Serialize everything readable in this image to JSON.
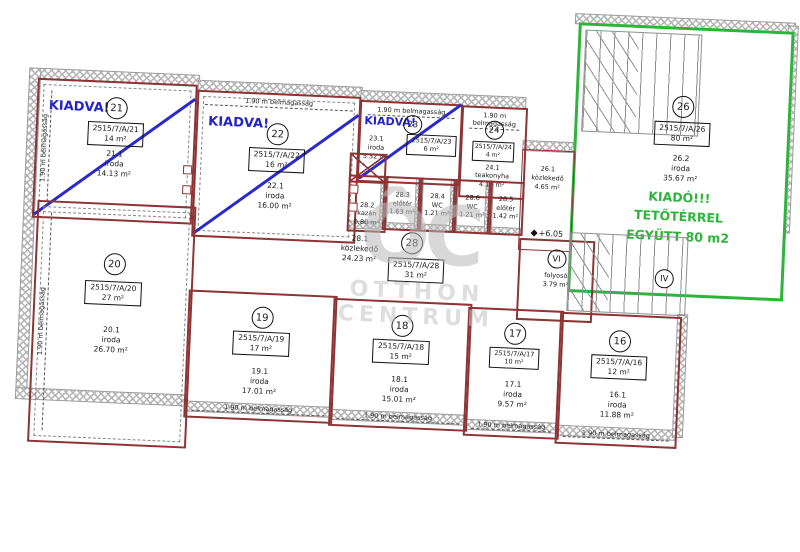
{
  "plan": {
    "height_note": "1.90 m belmagasság",
    "level_mark": "+6.05",
    "watermark": {
      "logo": "ÔC",
      "line1": "OTTHON",
      "line2": "CENTRUM"
    },
    "colors": {
      "wall": "#8d3434",
      "rented_blue": "#2323cc",
      "available_green": "#2eb43c",
      "hatch_gray": "#b4b4b4",
      "watermark_gray": "#c4c4c4"
    },
    "units": {
      "u16": {
        "num": "16",
        "lot": "2515/7/A/16",
        "lot_area": "12 m²",
        "room_no": "16.1",
        "room_type": "iroda",
        "room_area": "11.88 m²"
      },
      "u17": {
        "num": "17",
        "lot": "2515/7/A/17",
        "lot_area": "10 m²",
        "room_no": "17.1",
        "room_type": "iroda",
        "room_area": "9.57 m²"
      },
      "u18": {
        "num": "18",
        "lot": "2515/7/A/18",
        "lot_area": "15 m²",
        "room_no": "18.1",
        "room_type": "iroda",
        "room_area": "15.01 m²"
      },
      "u19": {
        "num": "19",
        "lot": "2515/7/A/19",
        "lot_area": "17 m²",
        "room_no": "19.1",
        "room_type": "iroda",
        "room_area": "17.01 m²"
      },
      "u20": {
        "num": "20",
        "lot": "2515/7/A/20",
        "lot_area": "27 m²",
        "room_no": "20.1",
        "room_type": "iroda",
        "room_area": "26.70 m²"
      },
      "u21": {
        "status": "KIADVA!",
        "num": "21",
        "lot": "2515/7/A/21",
        "lot_area": "14 m²",
        "room_no": "21.1",
        "room_type": "iroda",
        "room_area": "14.13 m²"
      },
      "u22": {
        "status": "KIADVA!",
        "num": "22",
        "lot": "2515/7/A/22",
        "lot_area": "16 m²",
        "room_no": "22.1",
        "room_type": "iroda",
        "room_area": "16.00 m²"
      },
      "u23": {
        "status": "KIADVA!",
        "num": "23",
        "lot": "2515/7/A/23",
        "lot_area": "6 m²",
        "room_no": "23.1",
        "room_type": "iroda",
        "room_area": "5.32 m²"
      },
      "u24": {
        "num": "24",
        "lot": "2515/7/A/24",
        "lot_area": "4 m²",
        "room_no": "24.1",
        "room_type": "teakonyha",
        "room_area": "4.15 m²"
      },
      "u26": {
        "num": "26",
        "lot": "2515/7/A/26",
        "lot_area": "80 m²",
        "room_no": "26.2",
        "room_type": "iroda",
        "room_area": "35.67 m²",
        "note1": "KIADÓ!!!",
        "note2": "TETŐTÉRREL",
        "note3": "EGYÜTT 80 m2"
      },
      "u28": {
        "num": "28",
        "lot": "2515/7/A/28",
        "lot_area": "31 m²",
        "room_no": "28.1",
        "room_type": "közlekedő",
        "room_area": "24.23 m²"
      }
    },
    "small_rooms": {
      "s282": {
        "no": "28.2",
        "type": "kazán",
        "area": "0.80 m²"
      },
      "s283": {
        "no": "28.3",
        "type": "előtér",
        "area": "1.63 m²"
      },
      "s284": {
        "no": "28.4",
        "type": "WC",
        "area": "1.21 m²"
      },
      "s286": {
        "no": "28.6",
        "type": "WC",
        "area": "1.21 m²"
      },
      "s285": {
        "no": "28.5",
        "type": "előtér",
        "area": "1.42 m²"
      },
      "s261": {
        "no": "26.1",
        "type": "közlekedő",
        "area": "4.65 m²"
      }
    },
    "corridor_vi": {
      "num": "VI",
      "type": "folyosó",
      "area": "3.79 m²"
    },
    "stair_label": "IV"
  }
}
